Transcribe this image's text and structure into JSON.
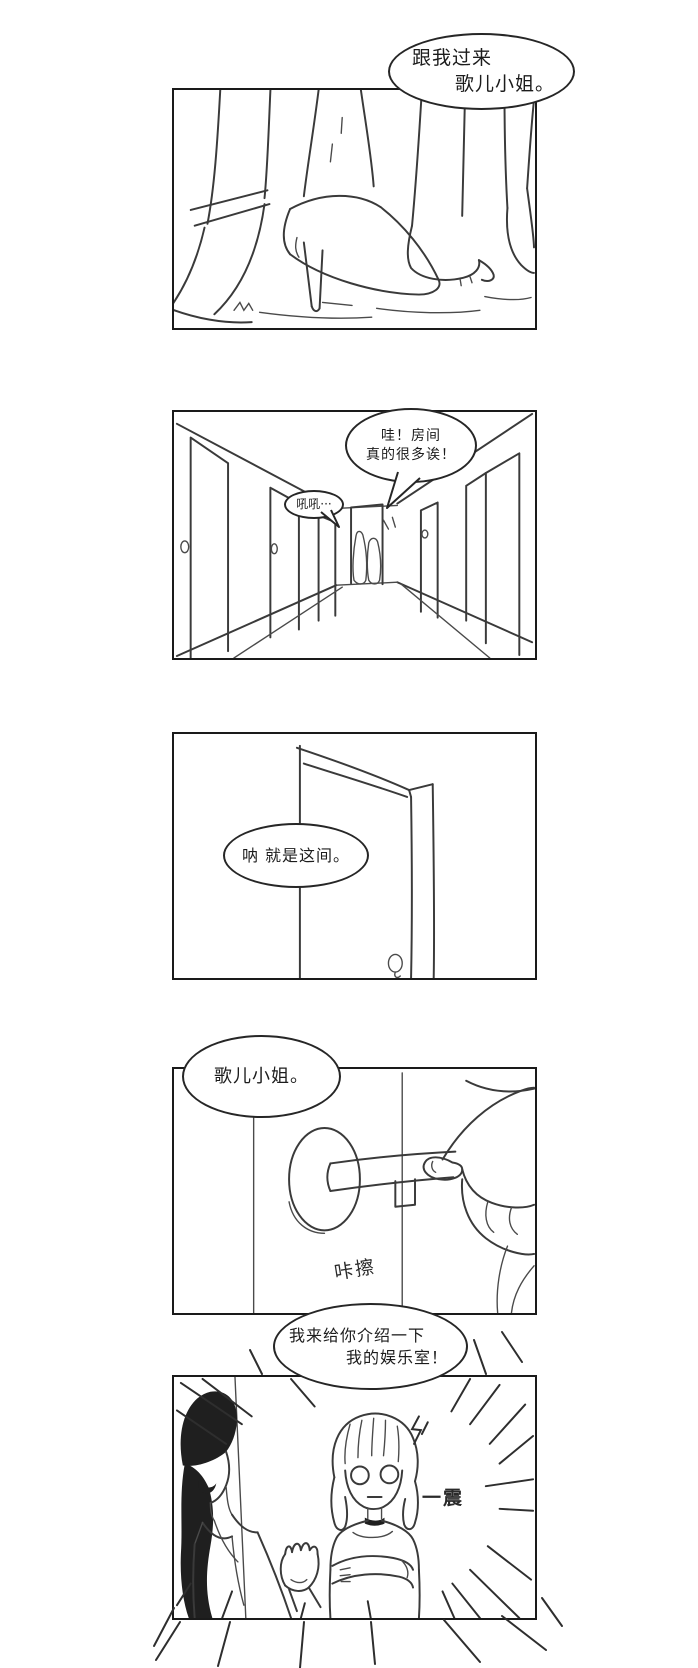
{
  "comic": {
    "colors": {
      "background": "#ffffff",
      "ink": "#1f1f1f",
      "panel_border": "#1a1a1a"
    },
    "panels": [
      {
        "name": "panel-1",
        "scene": "feet-high-heels-walking",
        "bubbles": [
          {
            "lines": [
              "跟我过来",
              "歌儿小姐。"
            ]
          }
        ]
      },
      {
        "name": "panel-2",
        "scene": "corridor-many-doors",
        "bubbles": [
          {
            "lines": [
              "哇！房间",
              "真的很多诶！"
            ]
          },
          {
            "lines": [
              "吼吼···"
            ]
          }
        ]
      },
      {
        "name": "panel-3",
        "scene": "open-door",
        "bubbles": [
          {
            "lines": [
              "呐 就是这间。"
            ]
          }
        ]
      },
      {
        "name": "panel-4",
        "scene": "hand-key-keyhole",
        "bubbles": [
          {
            "lines": [
              "歌儿小姐。"
            ]
          }
        ],
        "sfx": "咔擦"
      },
      {
        "name": "panel-5",
        "scene": "woman-presents-room-girl-startled",
        "bubbles": [
          {
            "lines": [
              "我来给你介绍一下",
              "我的娱乐室！"
            ]
          }
        ],
        "sfx": "一震"
      }
    ]
  }
}
